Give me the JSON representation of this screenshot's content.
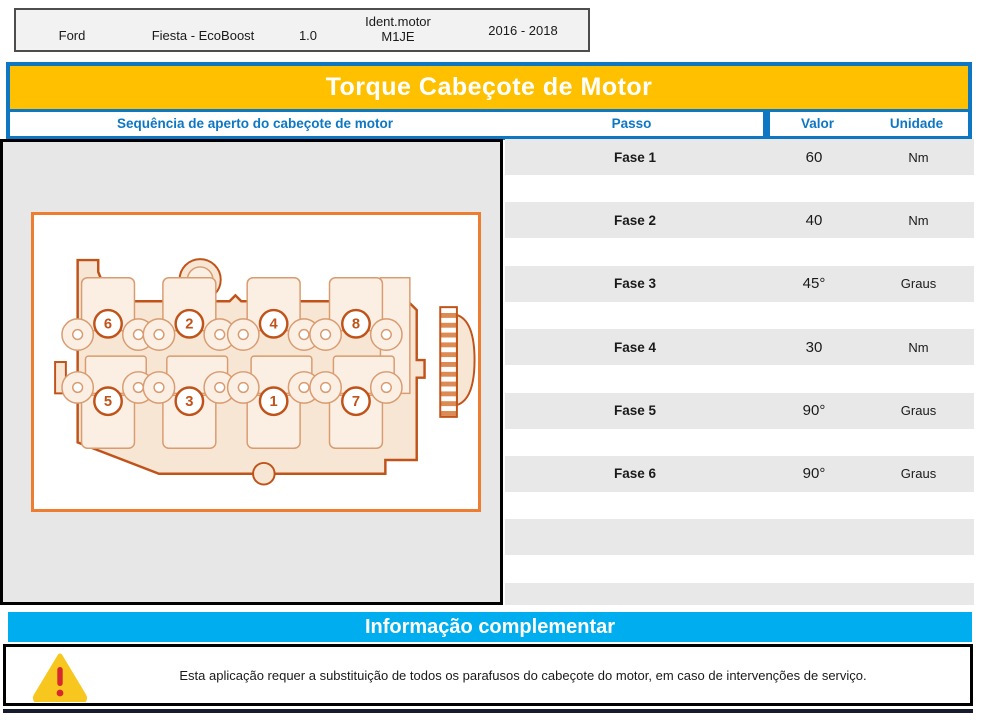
{
  "vehicle_header": {
    "make": "Ford",
    "model": "Fiesta - EcoBoost",
    "engine_capacity": "1.0",
    "engine_ident_label": "Ident.motor",
    "engine_code": "M1JE",
    "years": "2016 - 2018"
  },
  "title_bar": {
    "title": "Torque Cabeçote de Motor"
  },
  "table_header": {
    "sequence": "Sequência de aperto do cabeçote de motor",
    "step": "Passo",
    "value": "Valor",
    "unit": "Unidade"
  },
  "torque_steps": [
    {
      "step": "Fase 1",
      "value": "60",
      "unit": "Nm"
    },
    {
      "step": "Fase 2",
      "value": "40",
      "unit": "Nm"
    },
    {
      "step": "Fase 3",
      "value": "45°",
      "unit": "Graus"
    },
    {
      "step": "Fase 4",
      "value": "30",
      "unit": "Nm"
    },
    {
      "step": "Fase 5",
      "value": "90°",
      "unit": "Graus"
    },
    {
      "step": "Fase 6",
      "value": "90°",
      "unit": "Graus"
    }
  ],
  "diagram": {
    "description": "cylinder-head-bolt-tightening-sequence-top-view",
    "bolt_sequence_top_row": [
      "6",
      "2",
      "4",
      "8"
    ],
    "bolt_sequence_bottom_row": [
      "5",
      "3",
      "1",
      "7"
    ]
  },
  "complementary_info": {
    "title": "Informação complementar",
    "warning_icon": "warning-triangle-icon",
    "warning_text": "Esta aplicação requer a substituição de todos os parafusos do cabeçote do motor, em caso de intervenções de serviço."
  },
  "colors": {
    "accent_orange": "#FFC000",
    "accent_blue": "#0D77C3",
    "accent_cyan": "#00ADEE",
    "row_gray": "#E8E8E8",
    "diagram_orange": "#C0531A",
    "warning_yellow": "#F7C71F",
    "warning_red": "#D7282F"
  }
}
